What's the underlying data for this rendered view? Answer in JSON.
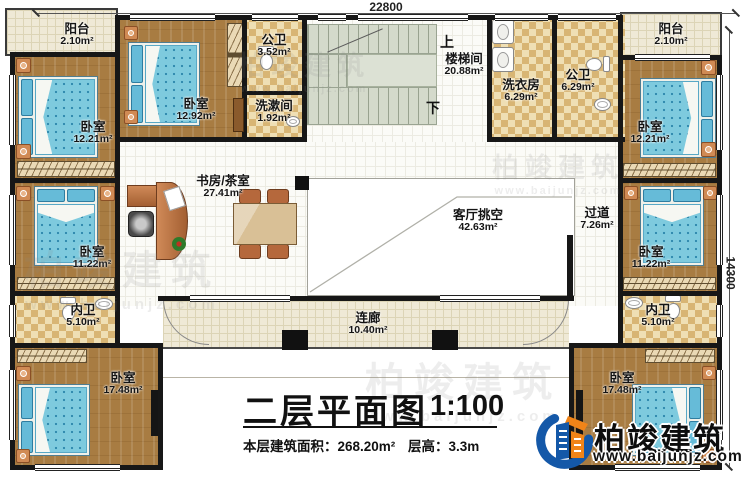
{
  "plan": {
    "dimensions": {
      "top": "22800",
      "right": "14300"
    },
    "stairs": {
      "up": "上",
      "down": "下"
    },
    "rooms": {
      "balcony_left": {
        "name": "阳台",
        "area": "2.10m²"
      },
      "bedroom_left_top": {
        "name": "卧室",
        "area": "12.21m²"
      },
      "bedroom_top_2": {
        "name": "卧室",
        "area": "12.92m²"
      },
      "bath_top_left": {
        "name": "公卫",
        "area": "3.52m²"
      },
      "washroom_top": {
        "name": "洗漱间",
        "area": "1.92m²"
      },
      "stairwell": {
        "name": "楼梯间",
        "area": "20.88m²"
      },
      "laundry": {
        "name": "洗衣房",
        "area": "6.29m²"
      },
      "bath_top_right": {
        "name": "公卫",
        "area": "6.29m²"
      },
      "balcony_right": {
        "name": "阳台",
        "area": "2.10m²"
      },
      "bedroom_right_top": {
        "name": "卧室",
        "area": "12.21m²"
      },
      "study_tea": {
        "name": "书房/茶室",
        "area": "27.41m²"
      },
      "living_void": {
        "name": "客厅挑空",
        "area": "42.63m²"
      },
      "hallway": {
        "name": "过道",
        "area": "7.26m²"
      },
      "bedroom_left_mid": {
        "name": "卧室",
        "area": "11.22m²"
      },
      "bedroom_right_mid": {
        "name": "卧室",
        "area": "11.22m²"
      },
      "bath_left": {
        "name": "内卫",
        "area": "5.10m²"
      },
      "bath_right": {
        "name": "内卫",
        "area": "5.10m²"
      },
      "bedroom_left_bottom": {
        "name": "卧室",
        "area": "17.48m²"
      },
      "bedroom_right_bottom": {
        "name": "卧室",
        "area": "17.48m²"
      },
      "corridor": {
        "name": "连廊",
        "area": "10.40m²"
      }
    }
  },
  "title_block": {
    "title": "二层平面图",
    "scale": "1:100",
    "area_label": "本层建筑面积：",
    "area_value": "268.20m²",
    "floor_height_label": "层高：",
    "floor_height_value": "3.3m"
  },
  "brand": {
    "name": "柏竣建筑",
    "website": "www.baijunjz.com"
  },
  "watermark": {
    "name": "柏竣建筑",
    "website": "www.baijunjz.com"
  },
  "colors": {
    "wall": "#171717",
    "wood_floor": "#a87c42",
    "bed_blue": "#7ecade",
    "tile_cream": "#efe9d6",
    "checker_tan": "#d8b574",
    "stair_gray": "#d4dacb",
    "logo_blue": "#1458a8",
    "logo_orange": "#f08418"
  }
}
